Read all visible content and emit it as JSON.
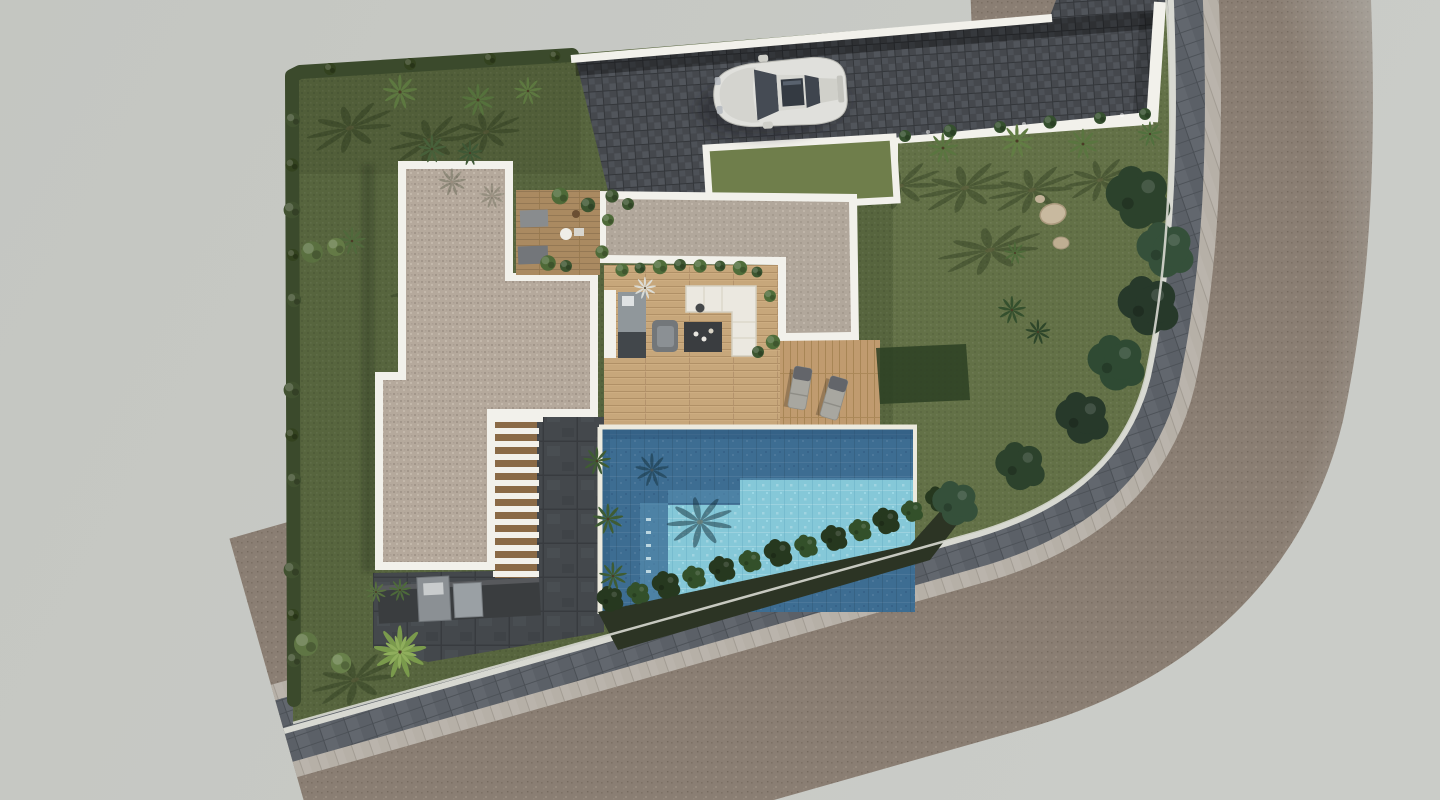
{
  "scene": {
    "type": "architectural-site-plan-3d-render",
    "view": "top-down aerial",
    "description": "Top-down 3D render of a modern single-family villa plot with flat gravel roofs, entrance courtyard, wooden terrace, rectangular swimming pool, louvered pergola stair, outdoor kitchen, lawns with palm trees and hedges, a paved driveway with a white sports car, and a curved perimeter road with sidewalk fading into a plain grey background"
  },
  "objects": [
    {
      "id": "background",
      "label": "plain studio backdrop"
    },
    {
      "id": "perimeter-road",
      "label": "asphalt road curving around plot"
    },
    {
      "id": "sidewalk",
      "label": "grey paver sidewalk band"
    },
    {
      "id": "curb",
      "label": "light stone curb strip"
    },
    {
      "id": "lawn",
      "label": "garden lawn"
    },
    {
      "id": "hedge",
      "label": "boundary hedge"
    },
    {
      "id": "driveway",
      "label": "dark cobble driveway"
    },
    {
      "id": "car",
      "label": "white sports car"
    },
    {
      "id": "lawn-patch",
      "label": "white-bordered lawn rectangle"
    },
    {
      "id": "roof-left",
      "label": "large gravel flat roof"
    },
    {
      "id": "roof-right",
      "label": "secondary gravel flat roof"
    },
    {
      "id": "courtyard",
      "label": "entrance courtyard wood deck"
    },
    {
      "id": "terrace",
      "label": "open living terrace with sofa set"
    },
    {
      "id": "pool",
      "label": "swimming pool with shallow step zone"
    },
    {
      "id": "pool-deck",
      "label": "wooden sun deck with loungers"
    },
    {
      "id": "pergola-stair",
      "label": "white louvered stair"
    },
    {
      "id": "stone-patio",
      "label": "charcoal stone patio"
    },
    {
      "id": "outdoor-kitchen",
      "label": "outdoor kitchen counter"
    },
    {
      "id": "palms",
      "label": "palm trees"
    },
    {
      "id": "trees",
      "label": "dark leafy boundary trees"
    },
    {
      "id": "rocks",
      "label": "decorative boulders"
    }
  ],
  "palette": {
    "bg": "#c7c9c5",
    "lawn1": "#57653e",
    "lawn2": "#637147",
    "lawn3": "#6f7e4b",
    "hedge": "#3b4a2c",
    "roof": "#b5a99c",
    "roof2": "#b1a79b",
    "white": "#f2f1eb",
    "drive": "#45484d",
    "walk": "#5b6067",
    "curb": "#b6b0a7",
    "asphalt": "#8a7e73",
    "wood": "#c7a77b",
    "deck": "#c09b6f",
    "cwood": "#aa8a61",
    "poolDeep": "#3d6d92",
    "poolMid": "#5b93b4",
    "poolLight": "#85c8d8",
    "patio": "#44484c",
    "counter": "#3a3d3f"
  }
}
